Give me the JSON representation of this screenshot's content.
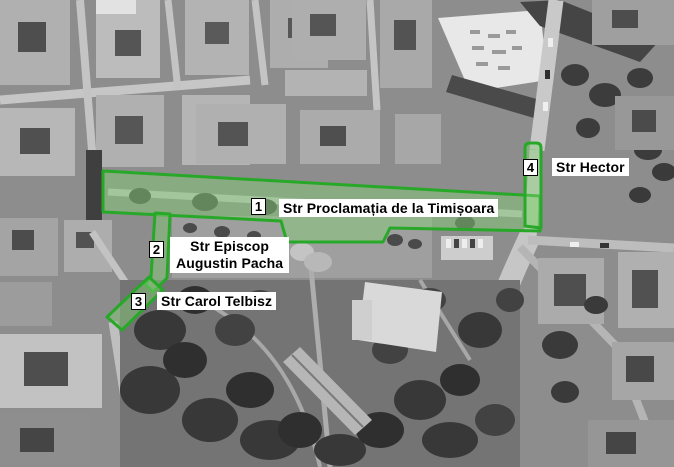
{
  "map": {
    "type": "aerial-photo-route-map",
    "streets": [
      {
        "marker": "1",
        "label": "Str Proclamația de la Timișoara"
      },
      {
        "marker": "2",
        "label_line1": "Str Episcop",
        "label_line2": "Augustin Pacha"
      },
      {
        "marker": "3",
        "label": "Str Carol Telbisz"
      },
      {
        "marker": "4",
        "label": "Str Hector"
      }
    ],
    "colors": {
      "route_outline": "#28a828",
      "route_fill_rgba": "rgba(132,208,118,0.45)",
      "label_background": "#ffffff",
      "label_text": "#000000"
    }
  }
}
